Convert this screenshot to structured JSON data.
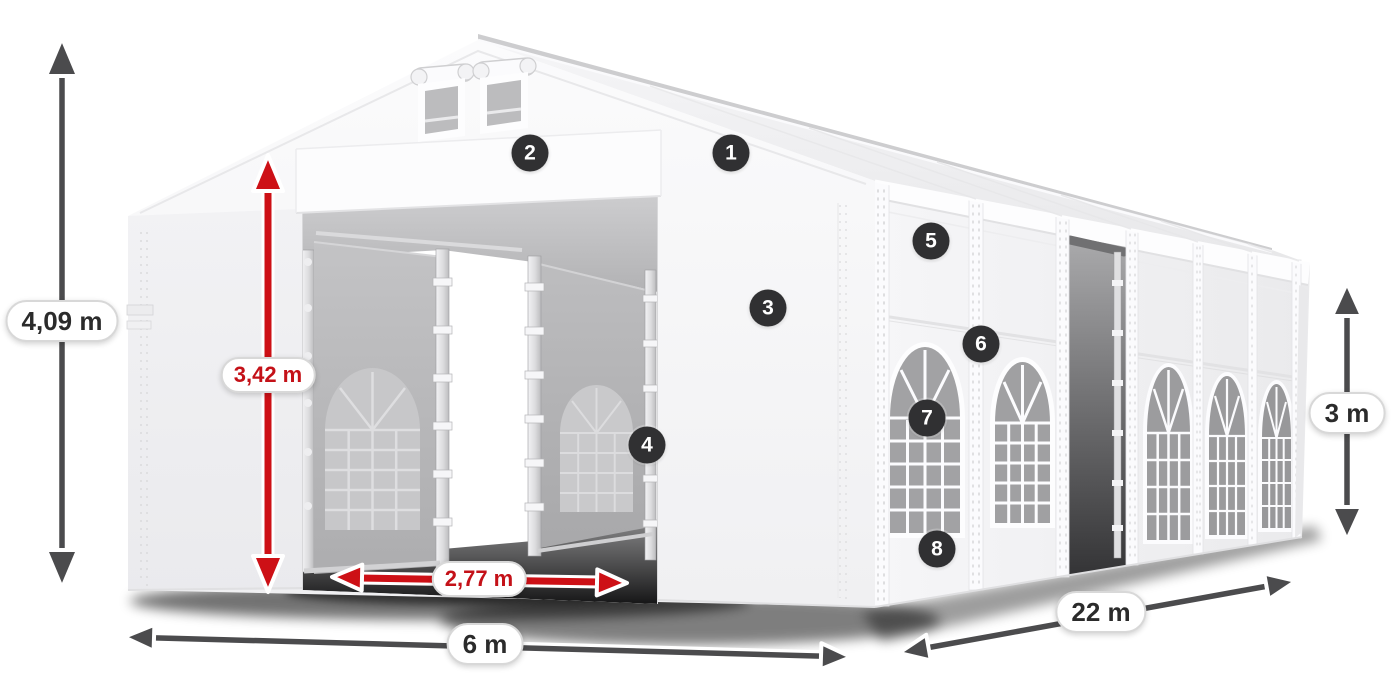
{
  "diagram": {
    "subject": "White marquee party tent with front entrance, roof vents and arched side windows",
    "background_color": "#ffffff"
  },
  "colors": {
    "arrow_dark": "#4b4b4d",
    "arrow_red": "#cd1016",
    "badge_background": "#303032",
    "badge_number": "#ffffff",
    "label_text_dark": "#2b2b2b",
    "label_text_red": "#c41118",
    "pill_background": "#ffffff",
    "pill_border": "#d8d8d8"
  },
  "dimensions": [
    {
      "id": "total-height",
      "label": "4,09 m",
      "style": "dark",
      "orientation": "vertical",
      "position": "far-left"
    },
    {
      "id": "entrance-height",
      "label": "3,42 m",
      "style": "red",
      "orientation": "vertical",
      "position": "front-entrance"
    },
    {
      "id": "entrance-width",
      "label": "2,77 m",
      "style": "red",
      "orientation": "horizontal",
      "position": "front-entrance"
    },
    {
      "id": "front-width",
      "label": "6 m",
      "style": "dark",
      "orientation": "horizontal",
      "position": "front-bottom"
    },
    {
      "id": "side-length",
      "label": "22 m",
      "style": "dark",
      "orientation": "diagonal",
      "position": "side-bottom"
    },
    {
      "id": "side-height",
      "label": "3 m",
      "style": "dark",
      "orientation": "vertical",
      "position": "far-right"
    }
  ],
  "callouts": [
    {
      "number": "1"
    },
    {
      "number": "2"
    },
    {
      "number": "3"
    },
    {
      "number": "4"
    },
    {
      "number": "5"
    },
    {
      "number": "6"
    },
    {
      "number": "7"
    },
    {
      "number": "8"
    }
  ]
}
